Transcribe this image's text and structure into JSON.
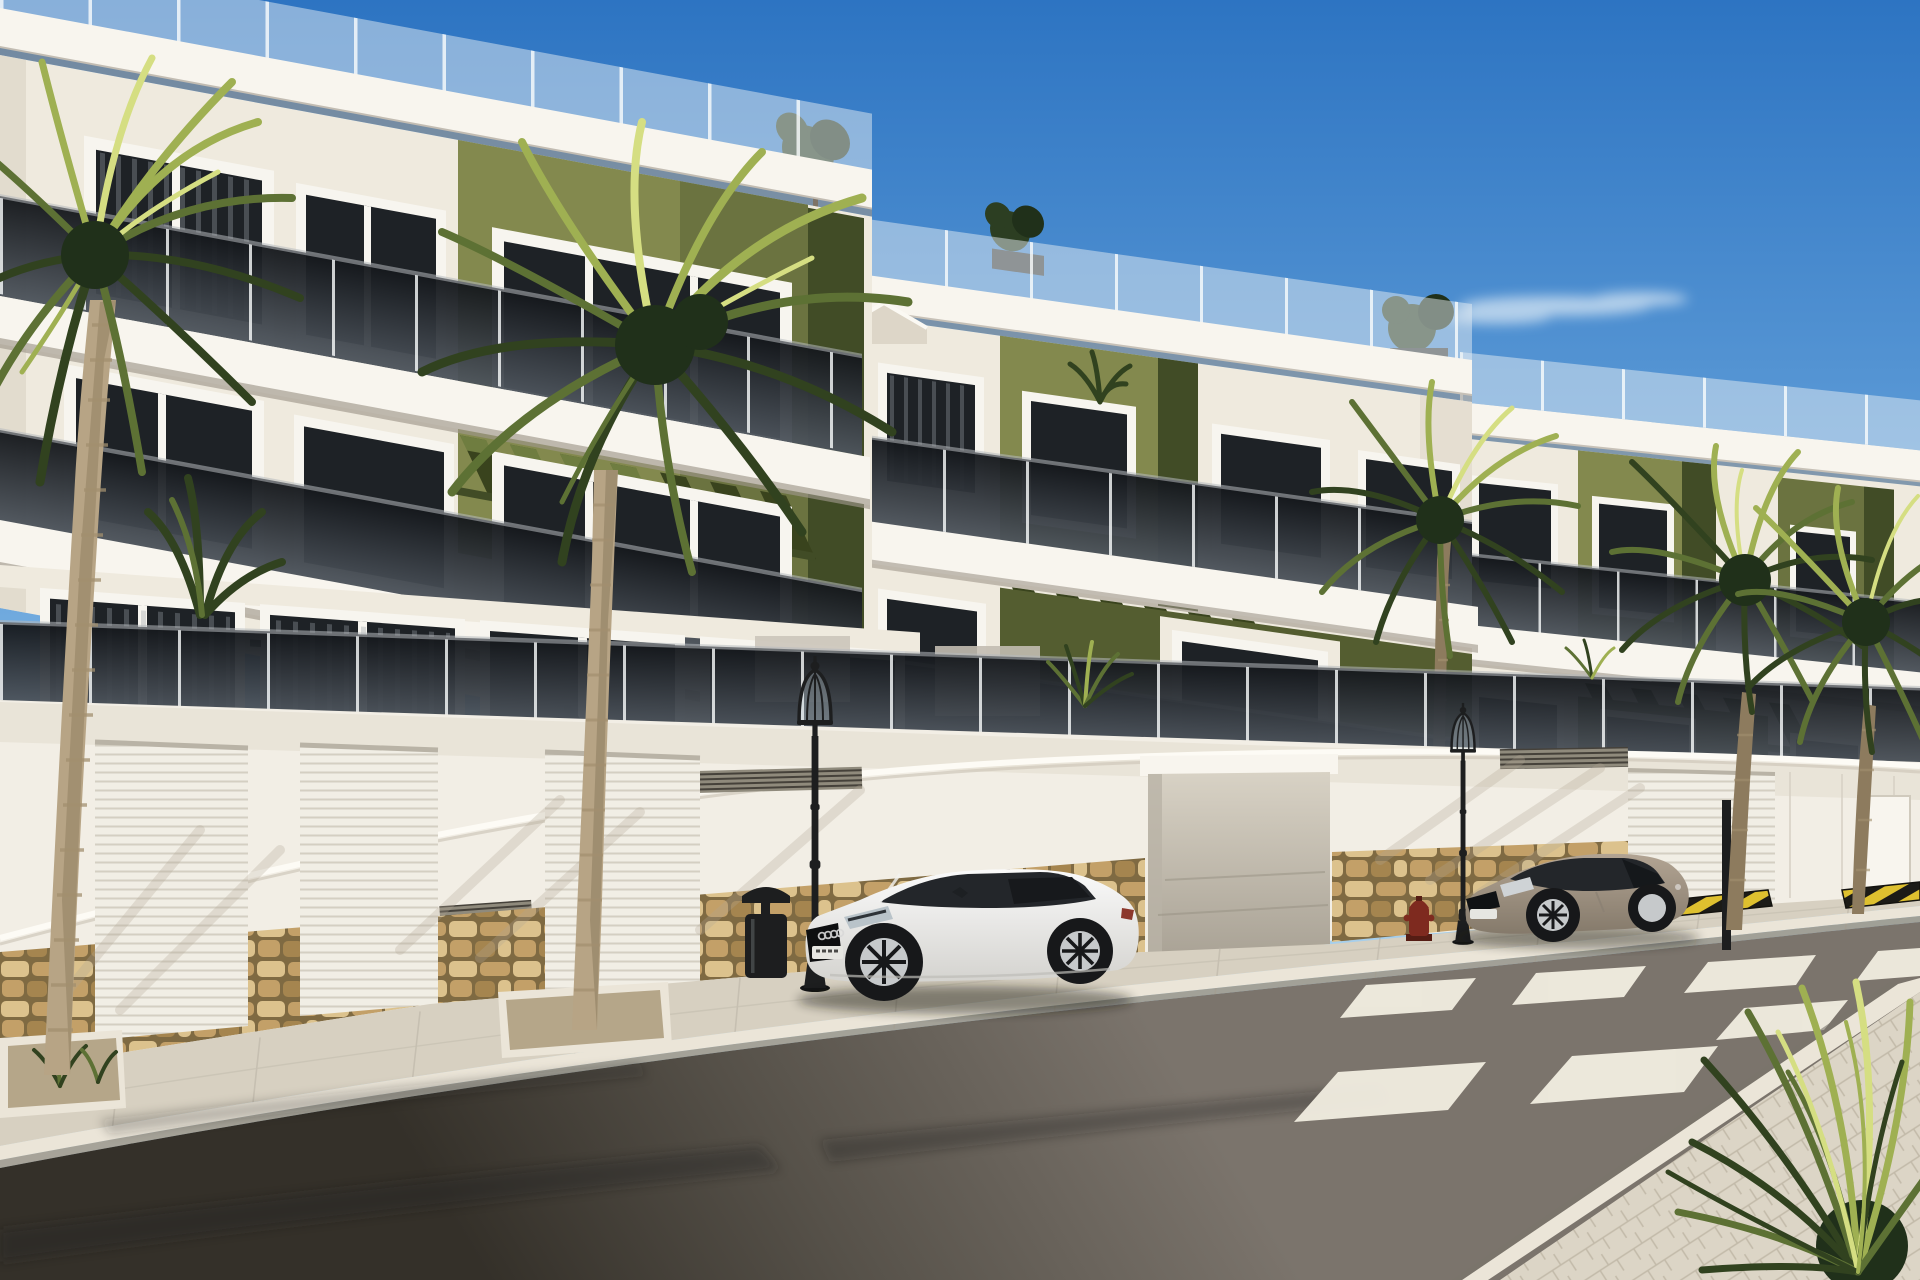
{
  "scene": {
    "description": "Sunny 3D architectural rendering of a modern three-storey apartment complex with white facades, olive-green accent panels, tinted glass balconies and rooftop terraces. Palm trees line the street; a white sports coupe and a beige coupe are parked along a white garage wall with a natural stone base. A zebra crosswalk with yellow-black curb markings is on the right, classic black street lamps stand on the pavement and a spiky green plant fills the lower-right foreground under a clear blue sky with one thin cloud.",
    "time_of_day": "day",
    "weather": "clear blue sky, one small wispy cloud",
    "style": "computer generated real-estate visualisation"
  },
  "objects": {
    "buildings": [
      "left apartment block",
      "center apartment block",
      "right apartment block",
      "small white gable between blocks"
    ],
    "vegetation": [
      "left foreground palm",
      "center foreground palm",
      "palm in front of right block",
      "pair of bushy palms far right",
      "spiky yucca bottom-right",
      "rooftop shrubs",
      "terrace plants",
      "agaves in left planter"
    ],
    "street_furniture": [
      "classic lantern street lamp left",
      "classic lantern street lamp right",
      "black litter bin",
      "red fire hydrant",
      "sign pole"
    ],
    "vehicles": [
      "white sports coupe",
      "beige coupe"
    ],
    "road_elements": [
      "zebra crosswalk",
      "yellow-black hazard curb marks",
      "stone-clad wall base",
      "garage doors",
      "driveway ramp",
      "paved sidewalks"
    ]
  },
  "counts": {
    "palm_trees": 5,
    "parked_cars": 2,
    "street_lamps": 2,
    "garage_doors": 4,
    "crosswalk_stripes": 7,
    "rooftop_shrubs": 3
  },
  "palette": {
    "sky_top": "#2d74c2",
    "sky_mid": "#69a5dc",
    "sky_low": "#b5d8ee",
    "sky_horizon": "#e2f0f8",
    "cloud_white": "#f6fafc",
    "facade_bright": "#f8f5ee",
    "facade_light": "#efeade",
    "facade_mid": "#ddd6c8",
    "facade_shade": "#c3bbab",
    "under_shadow": "#9e968a",
    "green_light": "#83894e",
    "green_mid": "#6b7340",
    "green_dark": "#545d30",
    "green_deep": "#414c26",
    "pergola_dark": "#39431d",
    "pergola_light": "#7d8c4a",
    "glass_top": "#14171b",
    "glass_bottom": "#4d545c",
    "window_glass": "#1e2226",
    "window_frame": "#f7f5ef",
    "curtain": "#9aa0a6",
    "roof_rail": "#e3ecf2",
    "rail_post": "#fafcfd",
    "wall_white": "#f2eee5",
    "wall_trim": "#fdfbf5",
    "wall_shadow_tint": "#b1a694",
    "stone_light": "#dcc28d",
    "stone_mid": "#c3a068",
    "stone_dark": "#a5854f",
    "stone_gap": "#7f6a42",
    "garage_door": "#f1eee5",
    "garage_rib": "#d4cfc2",
    "drive_top": "#d8d2c5",
    "drive_bottom": "#a9a295",
    "sidewalk": "#d7d0c1",
    "sidewalk_shade": "#b7b0a2",
    "curb_light": "#ebe5d8",
    "curb_shade": "#a09888",
    "paver_near": "#dcd5c6",
    "paver_line": "#c2baa9",
    "road_light": "#7b746c",
    "road_mid": "#565149",
    "road_dark": "#343029",
    "road_stain": "#262220",
    "crosswalk_white": "#f2eee1",
    "hazard_yellow": "#dec02f",
    "hazard_black": "#1c1b17",
    "metal_black": "#1d1e1f",
    "metal_highlight": "#5a5f61",
    "hydrant_red": "#7e2a1f",
    "trunk_light": "#b7a485",
    "trunk_dark": "#8d7b5e",
    "trunk_ring": "#a28f6f",
    "frond_dark": "#31421f",
    "frond_mid": "#5d7134",
    "frond_light": "#9fb052",
    "frond_lit": "#d5de82",
    "shrub_dark": "#2c3e22",
    "shrub_deep": "#20301a",
    "planter_gravel": "#b5a689",
    "car_white": "#fafafa",
    "car_white_shade": "#d4d3cf",
    "car_glass": "#23262a",
    "wheel_dark": "#17181a",
    "wheel_rim": "#c6c9cb",
    "car_beige": "#b2a493",
    "car_beige_shade": "#857a6b",
    "plate_white": "#e6e6e1",
    "taillight_red": "#8c372c"
  }
}
